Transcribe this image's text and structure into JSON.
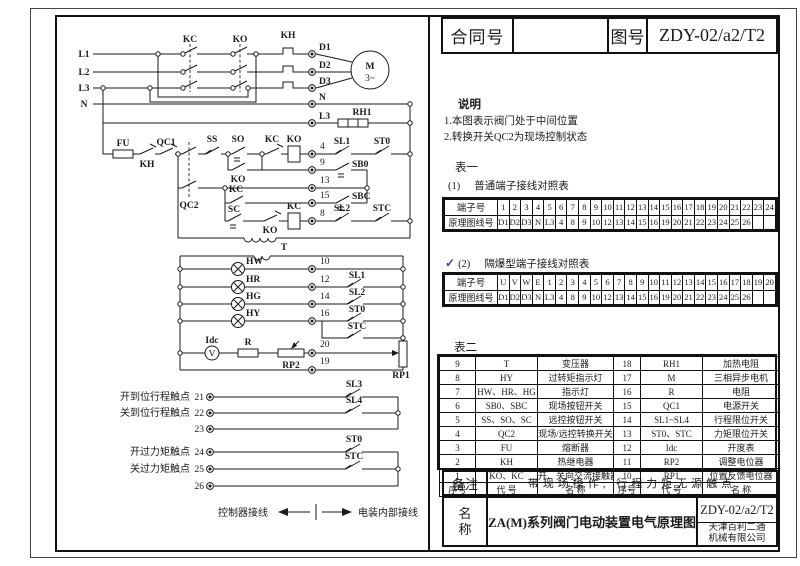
{
  "header": {
    "contract_label": "合同号",
    "contract_value": "",
    "drawing_label": "图号",
    "drawing_value": "ZDY-02/a2/T2"
  },
  "notes": {
    "title": "说明",
    "items": [
      "1.本图表示阀门处于中间位置",
      "2.转换开关QC2为现场控制状态"
    ]
  },
  "table1": {
    "title": "表一",
    "normal": {
      "marker": "(1)",
      "label": "普通端子接线对照表",
      "row1_label": "端子号",
      "row1": [
        "1",
        "2",
        "3",
        "4",
        "5",
        "6",
        "7",
        "8",
        "9",
        "10",
        "11",
        "12",
        "13",
        "14",
        "15",
        "16",
        "17",
        "18",
        "19",
        "20",
        "21",
        "22",
        "23",
        "24"
      ],
      "row2_label": "原理图线号",
      "row2": [
        "D1",
        "D2",
        "D3",
        "N",
        "L3",
        "4",
        "8",
        "9",
        "10",
        "12",
        "13",
        "14",
        "15",
        "16",
        "19",
        "20",
        "21",
        "22",
        "23",
        "24",
        "25",
        "26",
        "",
        ""
      ]
    },
    "flameproof": {
      "check": "✓",
      "marker": "(2)",
      "label": "隔爆型端子接线对照表",
      "row1_label": "端子号",
      "row1": [
        "U",
        "V",
        "W",
        "E",
        "1",
        "2",
        "3",
        "4",
        "5",
        "6",
        "7",
        "8",
        "9",
        "10",
        "11",
        "12",
        "13",
        "14",
        "15",
        "16",
        "17",
        "18",
        "19",
        "20"
      ],
      "row2_label": "原理图线号",
      "row2": [
        "D1",
        "D2",
        "D3",
        "N",
        "L3",
        "4",
        "8",
        "9",
        "10",
        "12",
        "13",
        "14",
        "15",
        "16",
        "19",
        "20",
        "21",
        "22",
        "23",
        "24",
        "25",
        "26",
        "",
        ""
      ]
    }
  },
  "table2": {
    "title": "表二",
    "rows": [
      [
        "9",
        "T",
        "变压器",
        "18",
        "RH1",
        "加热电阻"
      ],
      [
        "8",
        "HY",
        "过转矩指示灯",
        "17",
        "M",
        "三相异步电机"
      ],
      [
        "7",
        "HW、HR、HG",
        "指示灯",
        "16",
        "R",
        "电阻"
      ],
      [
        "6",
        "SB0、SBC",
        "现场按钮开关",
        "15",
        "QC1",
        "电源开关"
      ],
      [
        "5",
        "SS、SO、SC",
        "远控按钮开关",
        "14",
        "SL1~SL4",
        "行程限位开关"
      ],
      [
        "4",
        "QC2",
        "现场/远控转换开关",
        "13",
        "ST0、STC",
        "力矩限位开关"
      ],
      [
        "3",
        "FU",
        "熔断器",
        "12",
        "Idc",
        "开度表"
      ],
      [
        "2",
        "KH",
        "热继电器",
        "11",
        "RP2",
        "调整电位器"
      ],
      [
        "1",
        "KO、KC",
        "开、关向交流接触器",
        "10",
        "RP1",
        "位置反馈电位器"
      ],
      [
        "序号",
        "代  号",
        "名  称",
        "序号",
        "代  号",
        "名  称"
      ]
    ]
  },
  "remarks": {
    "label": "备注",
    "text": "带现场操作, 行程力矩无源触点"
  },
  "titleblock": {
    "label_line1": "名",
    "label_line2": "称",
    "name": "ZA(M)系列阀门电动装置电气原理图",
    "drawing_no": "ZDY-02/a2/T2",
    "company_line1": "天津百利二通",
    "company_line2": "机械有限公司"
  },
  "sch": {
    "l1": "L1",
    "l2": "L2",
    "l3": "L3",
    "n": "N",
    "kc": "KC",
    "ko": "KO",
    "kh": "KH",
    "d1": "D1",
    "d2": "D2",
    "d3": "D3",
    "wn": "N",
    "wl3": "L3",
    "rh1": "RH1",
    "m": "M",
    "m3": "3~",
    "fu": "FU",
    "qc1": "QC1",
    "qc2": "QC2",
    "ss": "SS",
    "so": "SO",
    "sc": "SC",
    "sb0": "SB0",
    "sbc": "SBC",
    "sl1": "SL1",
    "sl2": "SL2",
    "sl3": "SL3",
    "sl4": "SL4",
    "st0": "ST0",
    "stc": "STC",
    "t": "T",
    "hw": "HW",
    "hr": "HR",
    "hg": "HG",
    "hy": "HY",
    "idc": "Idc",
    "v": "V",
    "r": "R",
    "rp1": "RP1",
    "rp2": "RP2",
    "t4": "4",
    "t8": "8",
    "t9": "9",
    "t10": "10",
    "t12": "12",
    "t13": "13",
    "t14": "14",
    "t15": "15",
    "t16": "16",
    "t19": "19",
    "t20": "20",
    "t21": "21",
    "t22": "22",
    "t23": "23",
    "t24": "24",
    "t25": "25",
    "t26": "26",
    "open_travel": "开到位行程触点",
    "close_travel": "关到位行程触点",
    "open_torque": "开过力矩触点",
    "close_torque": "关过力矩触点",
    "wiring_left": "控制器接线",
    "wiring_right": "电装内部接线"
  }
}
